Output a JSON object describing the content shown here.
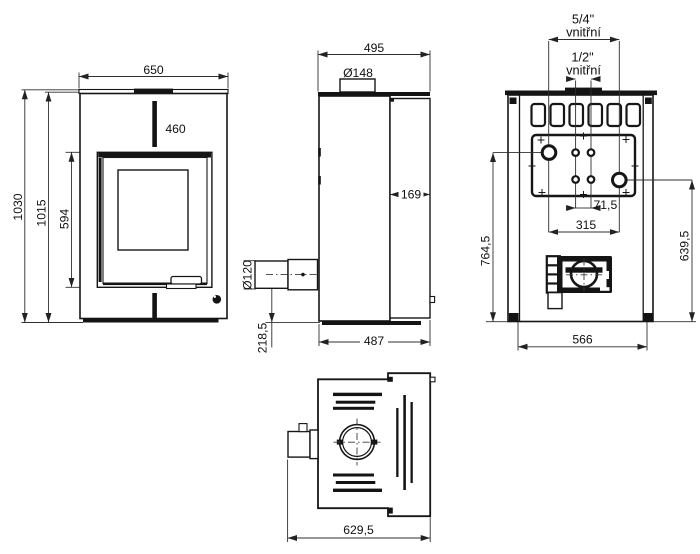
{
  "views": {
    "front": {
      "dims": {
        "top_width": "650",
        "door_width": "460",
        "total_height": "1030",
        "body_height": "1015",
        "door_height": "594"
      }
    },
    "side": {
      "dims": {
        "top_depth": "495",
        "flue_collar_diameter": "Ø148",
        "heat_exchanger_depth": "169",
        "air_inlet_diameter": "Ø120",
        "air_inlet_center_height": "218,5",
        "base_depth": "487"
      }
    },
    "rear": {
      "labels": {
        "large_fitting_size": "5/4\"",
        "large_fitting_type": "vnitřní",
        "small_fitting_size": "1/2\"",
        "small_fitting_type": "vnitřní"
      },
      "dims": {
        "small_fitting_spacing": "71,5",
        "large_fitting_spacing": "315",
        "upper_fitting_height": "764,5",
        "lower_fitting_height": "639,5",
        "base_width": "566"
      }
    },
    "top": {
      "dims": {
        "total_depth": "629,5"
      }
    }
  }
}
